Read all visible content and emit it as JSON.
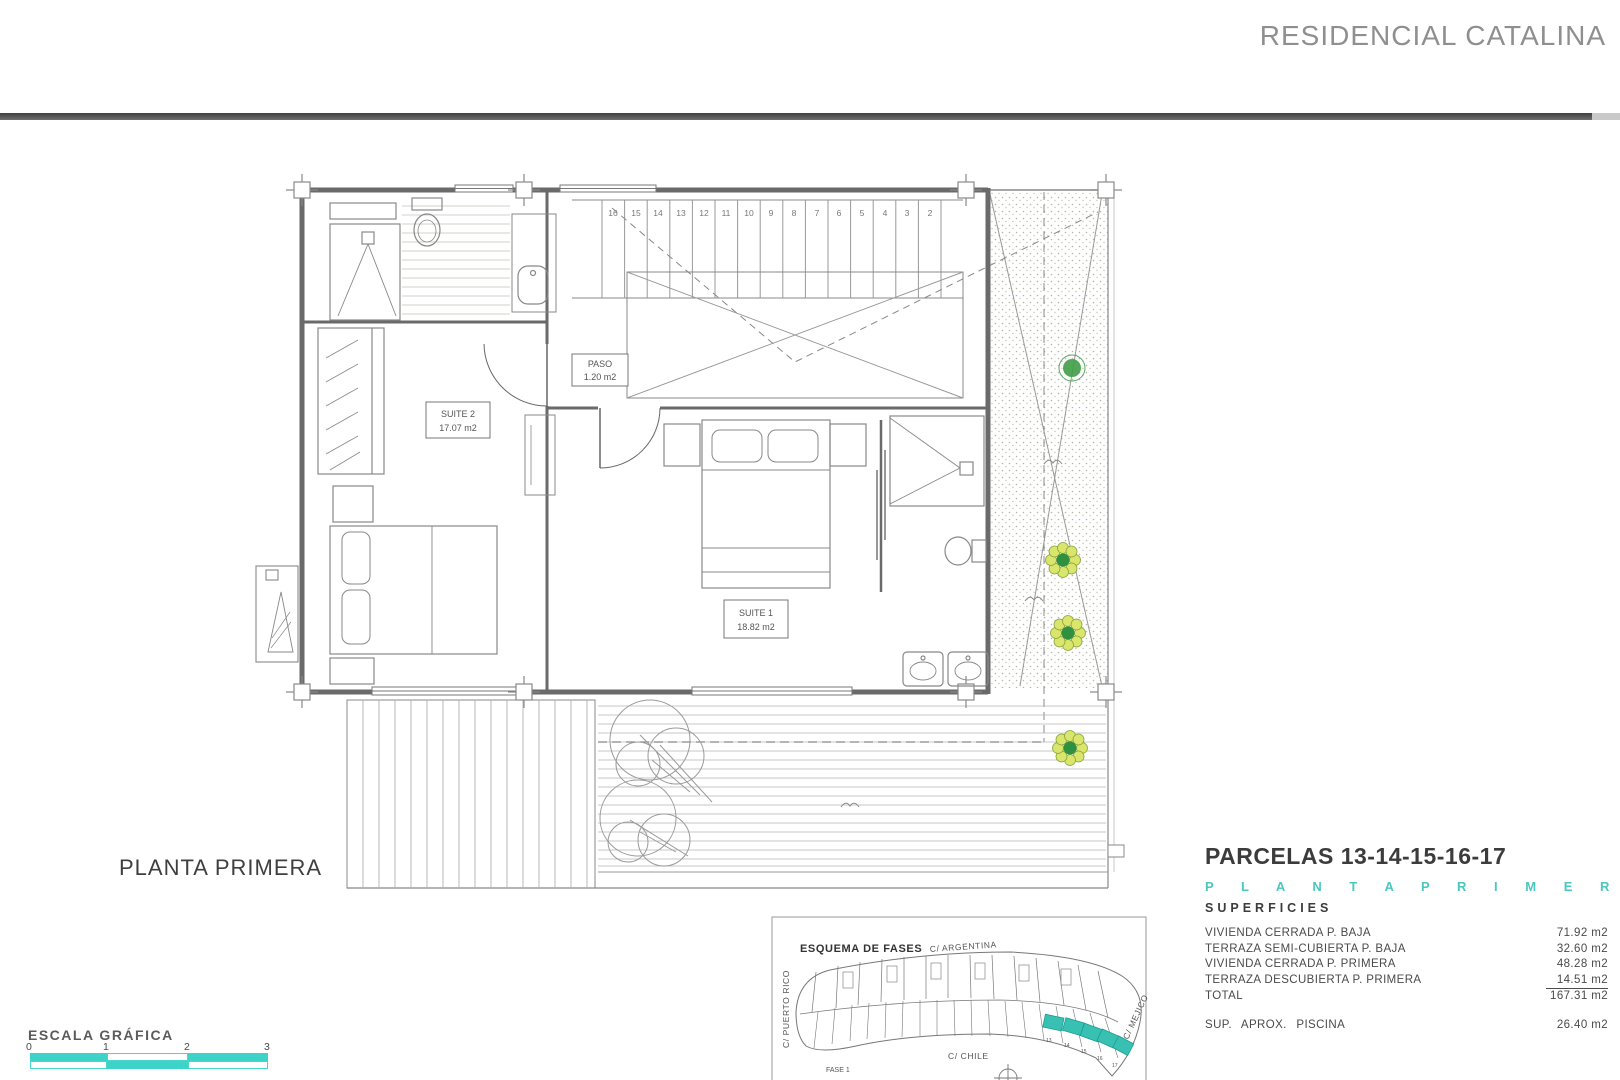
{
  "header": {
    "title": "RESIDENCIAL CATALINA"
  },
  "plan": {
    "label": "PLANTA PRIMERA",
    "rooms": {
      "suite2": {
        "name": "SUITE 2",
        "area": "17.07 m2"
      },
      "paso": {
        "name": "PASO",
        "area": "1.20 m2"
      },
      "suite1": {
        "name": "SUITE 1",
        "area": "18.82 m2"
      }
    },
    "stair_numbers": [
      "16",
      "15",
      "14",
      "13",
      "12",
      "11",
      "10",
      "9",
      "8",
      "7",
      "6",
      "5",
      "4",
      "3",
      "2"
    ]
  },
  "scale": {
    "label": "ESCALA GRÁFICA",
    "ticks": [
      "0",
      "1",
      "2",
      "3"
    ]
  },
  "inset": {
    "title": "ESQUEMA DE FASES",
    "streets": {
      "top": "C/ ARGENTINA",
      "left": "C/ PUERTO RICO",
      "bottom": "C/ CHILE",
      "right": "C/ MEJICO"
    },
    "phase_label": "FASE 1",
    "parcel_numbers": [
      "13",
      "14",
      "15",
      "16",
      "17"
    ]
  },
  "info": {
    "parcels_title": "PARCELAS 13-14-15-16-17",
    "floor_label": "P L A N T A     P R I M E R A",
    "section_label": "SUPERFICIES",
    "rows": [
      {
        "label": "VIVIENDA CERRADA P. BAJA",
        "value": "71.92 m2"
      },
      {
        "label": "TERRAZA SEMI-CUBIERTA P. BAJA",
        "value": "32.60 m2"
      },
      {
        "label": "VIVIENDA CERRADA P. PRIMERA",
        "value": "48.28 m2"
      },
      {
        "label": "TERRAZA DESCUBIERTA P. PRIMERA",
        "value": "14.51 m2"
      },
      {
        "label": "TOTAL",
        "value": "167.31 m2"
      }
    ],
    "pool_row": {
      "label": "SUP. APROX. PISCINA",
      "value": "26.40 m2"
    }
  },
  "colors": {
    "accent_teal": "#3DD3C9",
    "parcel_highlight": "#38C1B3",
    "title_gray": "#8F8F8F"
  }
}
